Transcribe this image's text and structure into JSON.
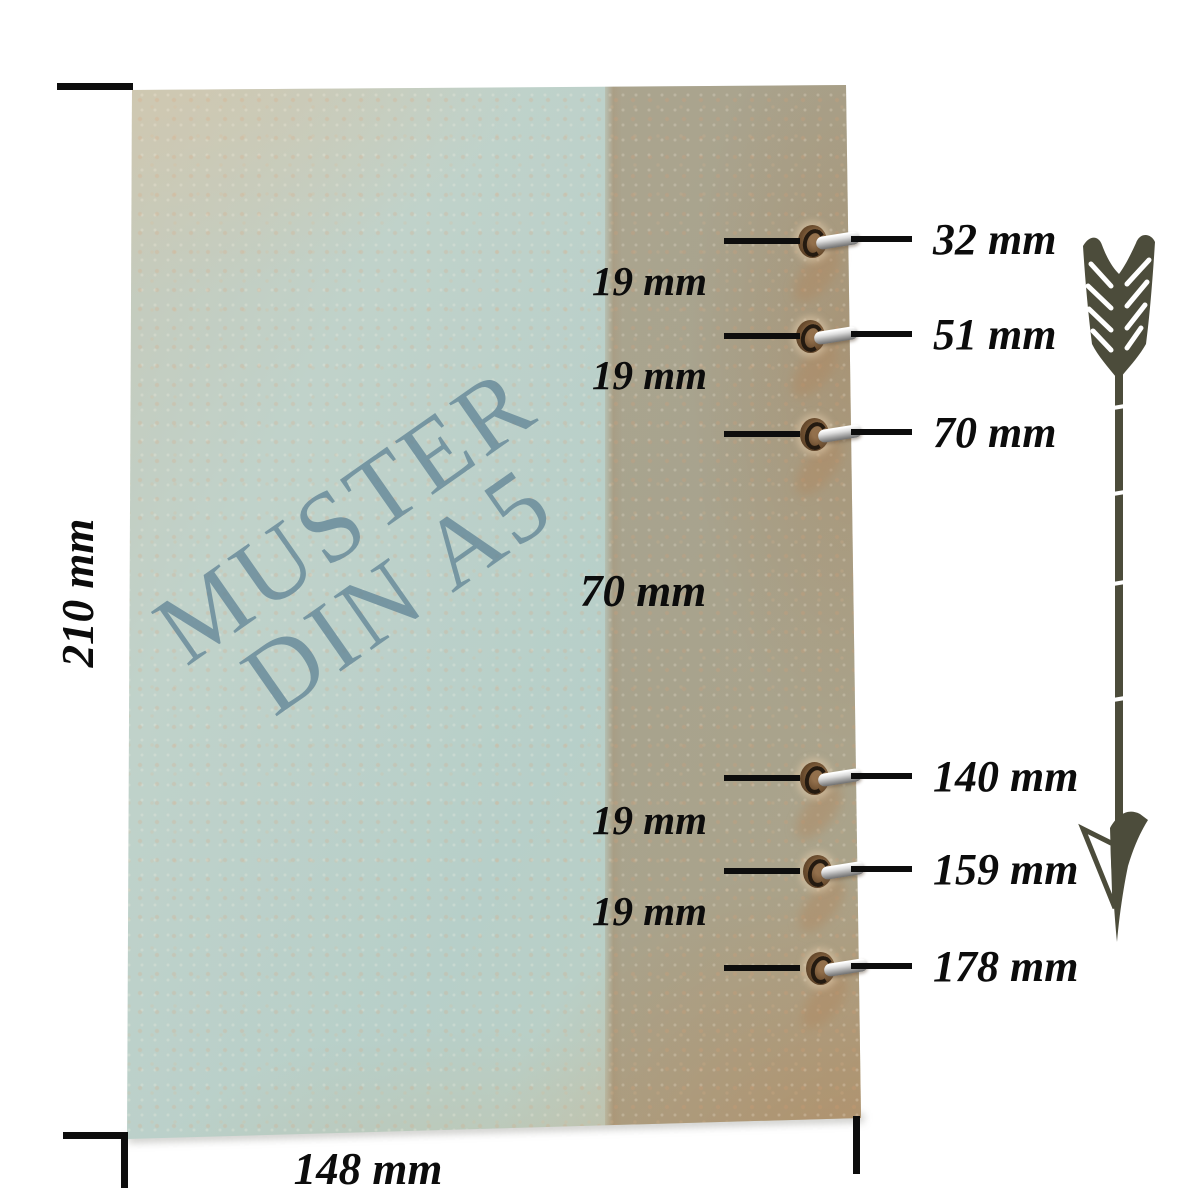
{
  "sheet": {
    "watermark_line1": "MUSTER",
    "watermark_line2": "DIN A5",
    "height_label": "210 mm",
    "width_label": "148 mm"
  },
  "holes": [
    {
      "label": "32 mm"
    },
    {
      "label": "51 mm"
    },
    {
      "label": "70 mm"
    },
    {
      "label": "140 mm"
    },
    {
      "label": "159 mm"
    },
    {
      "label": "178 mm"
    }
  ],
  "gaps": [
    {
      "label": "19 mm"
    },
    {
      "label": "19 mm"
    },
    {
      "label": "70 mm"
    },
    {
      "label": "19 mm"
    },
    {
      "label": "19 mm"
    }
  ],
  "measurements": {
    "sheet_width_mm": 148,
    "sheet_height_mm": 210,
    "hole_positions_from_top_mm": [
      32,
      51,
      70,
      140,
      159,
      178
    ],
    "hole_spacings_mm": [
      19,
      19,
      70,
      19,
      19
    ]
  },
  "icons": {
    "arrow": "down-arrow-icon"
  },
  "colors": {
    "background": "#ffffff",
    "paper_blue": "#b7cfc9",
    "paper_beige": "#cdc3ac",
    "paper_tan": "#c8b795",
    "edge_brown": "#986c42",
    "watermark": "#6789 98",
    "ink": "#0d0d0d",
    "hole_brown": "#5d4228",
    "ring_silver": "#c6c6c6",
    "arrow_olive": "#4c4c3b"
  }
}
